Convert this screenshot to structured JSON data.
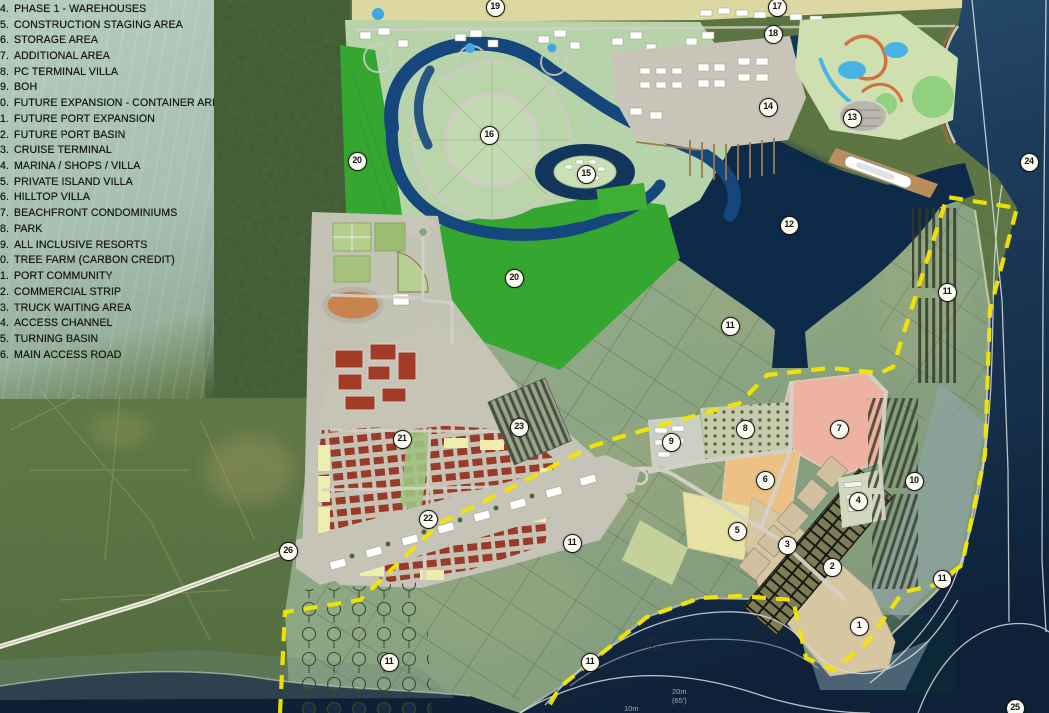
{
  "map": {
    "legend": {
      "items": [
        {
          "num": "4",
          "label": "PHASE 1 - WAREHOUSES"
        },
        {
          "num": "5",
          "label": "CONSTRUCTION STAGING AREA"
        },
        {
          "num": "6",
          "label": "STORAGE AREA"
        },
        {
          "num": "7",
          "label": "ADDITIONAL AREA"
        },
        {
          "num": "8",
          "label": "PC TERMINAL VILLA"
        },
        {
          "num": "9",
          "label": "BOH"
        },
        {
          "num": "10",
          "label": "FUTURE EXPANSION - CONTAINER AREA"
        },
        {
          "num": "11",
          "label": "FUTURE PORT EXPANSION"
        },
        {
          "num": "12",
          "label": "FUTURE PORT BASIN"
        },
        {
          "num": "13",
          "label": "CRUISE TERMINAL"
        },
        {
          "num": "14",
          "label": "MARINA / SHOPS / VILLA"
        },
        {
          "num": "15",
          "label": "PRIVATE ISLAND VILLA"
        },
        {
          "num": "16",
          "label": "HILLTOP VILLA"
        },
        {
          "num": "17",
          "label": "BEACHFRONT CONDOMINIUMS"
        },
        {
          "num": "18",
          "label": "PARK"
        },
        {
          "num": "19",
          "label": "ALL INCLUSIVE RESORTS"
        },
        {
          "num": "20",
          "label": "TREE FARM (CARBON CREDIT)"
        },
        {
          "num": "21",
          "label": "PORT COMMUNITY"
        },
        {
          "num": "22",
          "label": "COMMERCIAL STRIP"
        },
        {
          "num": "23",
          "label": "TRUCK WAITING AREA"
        },
        {
          "num": "24",
          "label": "ACCESS CHANNEL"
        },
        {
          "num": "25",
          "label": "TURNING BASIN"
        },
        {
          "num": "26",
          "label": "MAIN ACCESS ROAD"
        }
      ]
    },
    "markers": [
      {
        "n": "19",
        "x": 494,
        "y": 6
      },
      {
        "n": "17",
        "x": 776,
        "y": 6
      },
      {
        "n": "18",
        "x": 772,
        "y": 33
      },
      {
        "n": "14",
        "x": 767,
        "y": 106
      },
      {
        "n": "13",
        "x": 851,
        "y": 117
      },
      {
        "n": "16",
        "x": 488,
        "y": 134
      },
      {
        "n": "20",
        "x": 356,
        "y": 160
      },
      {
        "n": "24",
        "x": 1028,
        "y": 161
      },
      {
        "n": "15",
        "x": 585,
        "y": 173
      },
      {
        "n": "12",
        "x": 788,
        "y": 224
      },
      {
        "n": "20",
        "x": 513,
        "y": 277
      },
      {
        "n": "11",
        "x": 946,
        "y": 291
      },
      {
        "n": "11",
        "x": 729,
        "y": 325
      },
      {
        "n": "23",
        "x": 518,
        "y": 426
      },
      {
        "n": "8",
        "x": 744,
        "y": 428
      },
      {
        "n": "7",
        "x": 838,
        "y": 428
      },
      {
        "n": "21",
        "x": 401,
        "y": 438
      },
      {
        "n": "9",
        "x": 670,
        "y": 441
      },
      {
        "n": "6",
        "x": 764,
        "y": 479
      },
      {
        "n": "10",
        "x": 913,
        "y": 480
      },
      {
        "n": "4",
        "x": 857,
        "y": 500
      },
      {
        "n": "22",
        "x": 427,
        "y": 518
      },
      {
        "n": "5",
        "x": 736,
        "y": 530
      },
      {
        "n": "11",
        "x": 571,
        "y": 542
      },
      {
        "n": "3",
        "x": 786,
        "y": 544
      },
      {
        "n": "26",
        "x": 287,
        "y": 550
      },
      {
        "n": "2",
        "x": 831,
        "y": 566
      },
      {
        "n": "11",
        "x": 941,
        "y": 578
      },
      {
        "n": "1",
        "x": 858,
        "y": 625
      },
      {
        "n": "11",
        "x": 388,
        "y": 661
      },
      {
        "n": "11",
        "x": 589,
        "y": 661
      },
      {
        "n": "25",
        "x": 1014,
        "y": 707
      }
    ],
    "depth_labels": [
      {
        "label": "5m",
        "detail": "(16')",
        "x": 648,
        "y": 636,
        "tone": "dark"
      },
      {
        "label": "20m",
        "detail": "(65')",
        "x": 672,
        "y": 688,
        "tone": "light"
      },
      {
        "label": "10m",
        "detail": "",
        "x": 624,
        "y": 705,
        "tone": "light"
      }
    ],
    "colors": {
      "boundary_dash": "#f3e600",
      "ocean_deep": "#0e2138",
      "port_basin": "#0d2b49",
      "tree_farm_green": "#35a62f",
      "zone7_pink": "#eeb2a0",
      "zone6_orange": "#edc083",
      "zone5_yellow": "#e6e2a4",
      "town_red": "#9a3a28",
      "marker_bg": "#fbfbf3"
    }
  }
}
